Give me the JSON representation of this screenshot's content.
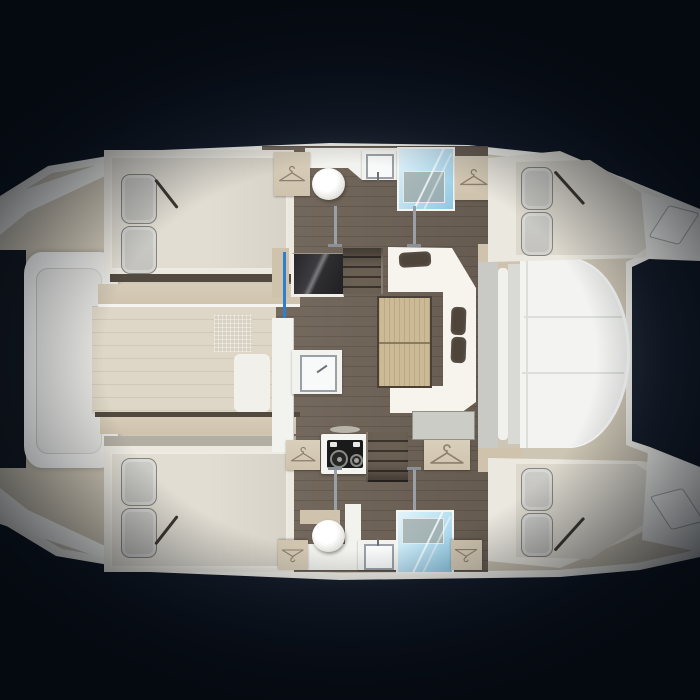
{
  "scene": {
    "description": "Top-down interior layout floor plan of a catamaran yacht on a dark vignetted background, bow to the left and twin stern platforms to the right",
    "text_content": "none - the drawing contains no visible text or numbers"
  },
  "palette": {
    "bgDeep": "#0a111d",
    "glow1": "#5a646e",
    "glow2": "#2a3340",
    "hull": "#efeee8",
    "deck": "#d7cfbf",
    "deckShade": "#c9c1af",
    "foredeck": "#ded7c7",
    "tan": "#cfc3ad",
    "wood": "#6e6256",
    "surround": "#ebe8df",
    "mattress": "#e1ddd3",
    "pillow": "#c3c2bd",
    "sofa": "#f4f2ea",
    "cushion": "#4e443a",
    "tableWood": "#ccb995",
    "showerHi": "#e2f4fc",
    "showerLo": "#8ec8e2",
    "stove": "#1a1a1a",
    "cockpit": "#f3f4f2",
    "bench": "#c9c9c5",
    "seam": "#dcded9",
    "blue": "#2e7fd0",
    "steel": "#9aa0a6",
    "grayBand": "#b3aea4",
    "trampoline": "#10161f",
    "white": "#f2f2ee"
  },
  "icons": [
    "hanger-icon",
    "toilet-icon",
    "sink-icon",
    "shower-icon",
    "stove-icon",
    "stairs-icon"
  ],
  "areas": [
    "forward-cabin-upper",
    "forward-cabin-lower",
    "bathroom-upper",
    "bathroom-lower",
    "aft-cabin-upper",
    "aft-cabin-lower",
    "salon-with-sofa-and-table",
    "galley-with-sink-and-stove",
    "cockpit",
    "bow-seat-pod",
    "trampoline",
    "foredeck",
    "stern-platform-upper",
    "stern-platform-lower"
  ]
}
